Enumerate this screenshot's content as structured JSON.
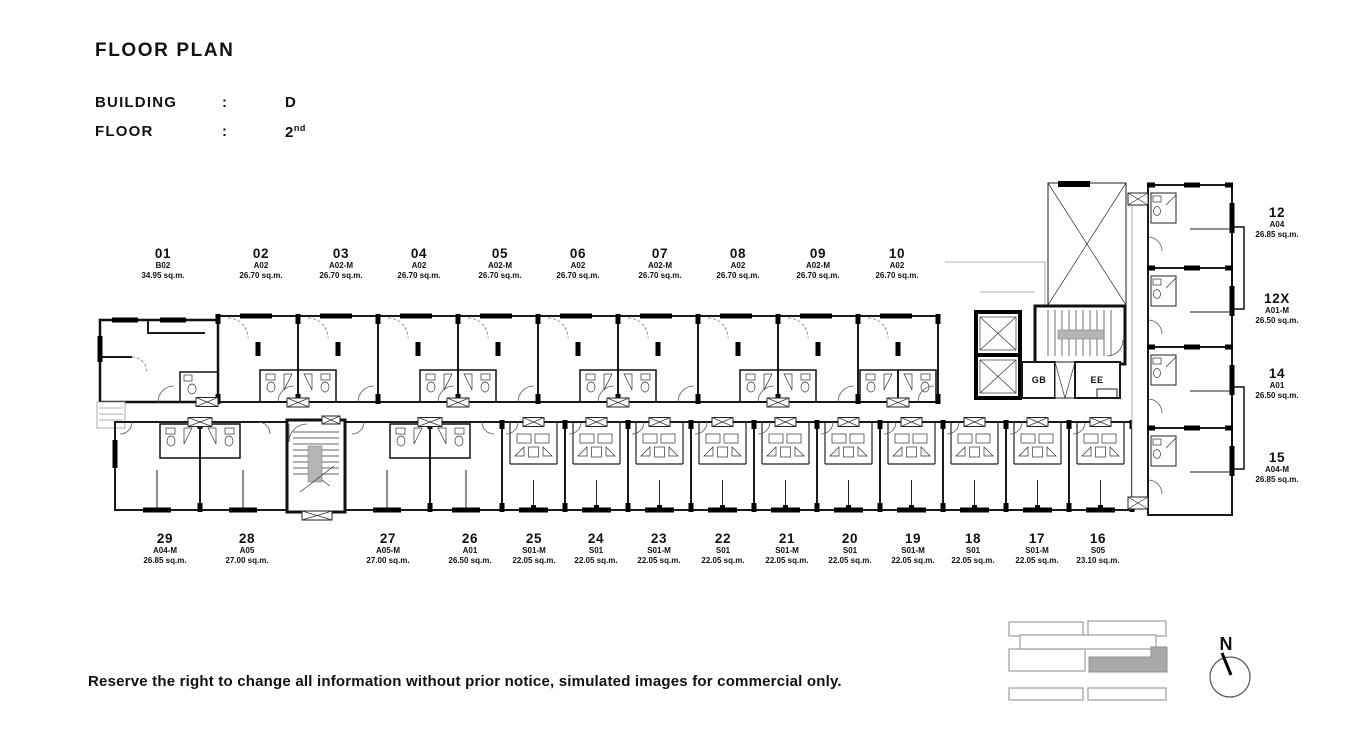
{
  "header": {
    "title": "FLOOR PLAN",
    "building_label": "BUILDING",
    "floor_label": "FLOOR",
    "colon": ":",
    "building_value": "D",
    "floor_value": "2",
    "floor_ordinal": "nd"
  },
  "units": {
    "top": [
      {
        "no": "01",
        "type": "B02",
        "area": "34.95 sq.m."
      },
      {
        "no": "02",
        "type": "A02",
        "area": "26.70 sq.m."
      },
      {
        "no": "03",
        "type": "A02-M",
        "area": "26.70 sq.m."
      },
      {
        "no": "04",
        "type": "A02",
        "area": "26.70 sq.m."
      },
      {
        "no": "05",
        "type": "A02-M",
        "area": "26.70 sq.m."
      },
      {
        "no": "06",
        "type": "A02",
        "area": "26.70 sq.m."
      },
      {
        "no": "07",
        "type": "A02-M",
        "area": "26.70 sq.m."
      },
      {
        "no": "08",
        "type": "A02",
        "area": "26.70 sq.m."
      },
      {
        "no": "09",
        "type": "A02-M",
        "area": "26.70 sq.m."
      },
      {
        "no": "10",
        "type": "A02",
        "area": "26.70 sq.m."
      }
    ],
    "right": [
      {
        "no": "12",
        "type": "A04",
        "area": "26.85 sq.m."
      },
      {
        "no": "12X",
        "type": "A01-M",
        "area": "26.50 sq.m."
      },
      {
        "no": "14",
        "type": "A01",
        "area": "26.50 sq.m."
      },
      {
        "no": "15",
        "type": "A04-M",
        "area": "26.85 sq.m."
      }
    ],
    "bottom": [
      {
        "no": "29",
        "type": "A04-M",
        "area": "26.85 sq.m."
      },
      {
        "no": "28",
        "type": "A05",
        "area": "27.00 sq.m."
      },
      {
        "no": "27",
        "type": "A05-M",
        "area": "27.00 sq.m."
      },
      {
        "no": "26",
        "type": "A01",
        "area": "26.50 sq.m."
      },
      {
        "no": "25",
        "type": "S01-M",
        "area": "22.05 sq.m."
      },
      {
        "no": "24",
        "type": "S01",
        "area": "22.05 sq.m."
      },
      {
        "no": "23",
        "type": "S01-M",
        "area": "22.05 sq.m."
      },
      {
        "no": "22",
        "type": "S01",
        "area": "22.05 sq.m."
      },
      {
        "no": "21",
        "type": "S01-M",
        "area": "22.05 sq.m."
      },
      {
        "no": "20",
        "type": "S01",
        "area": "22.05 sq.m."
      },
      {
        "no": "19",
        "type": "S01-M",
        "area": "22.05 sq.m."
      },
      {
        "no": "18",
        "type": "S01",
        "area": "22.05 sq.m."
      },
      {
        "no": "17",
        "type": "S01-M",
        "area": "22.05 sq.m."
      },
      {
        "no": "16",
        "type": "S05",
        "area": "23.10 sq.m."
      }
    ]
  },
  "core": {
    "gb_label": "GB",
    "ee_label": "EE"
  },
  "north_label": "N",
  "disclaimer": "Reserve the right to change all information without prior notice, simulated images for commercial only.",
  "colors": {
    "unit01": "#96877b",
    "wing_top": "#cbc2bc",
    "wing_mauve": "#b5a8a2",
    "wing_s": "#dbd7cf",
    "wing_right": "#c2b5af",
    "keyplan_highlight": "#a9a9a9"
  }
}
